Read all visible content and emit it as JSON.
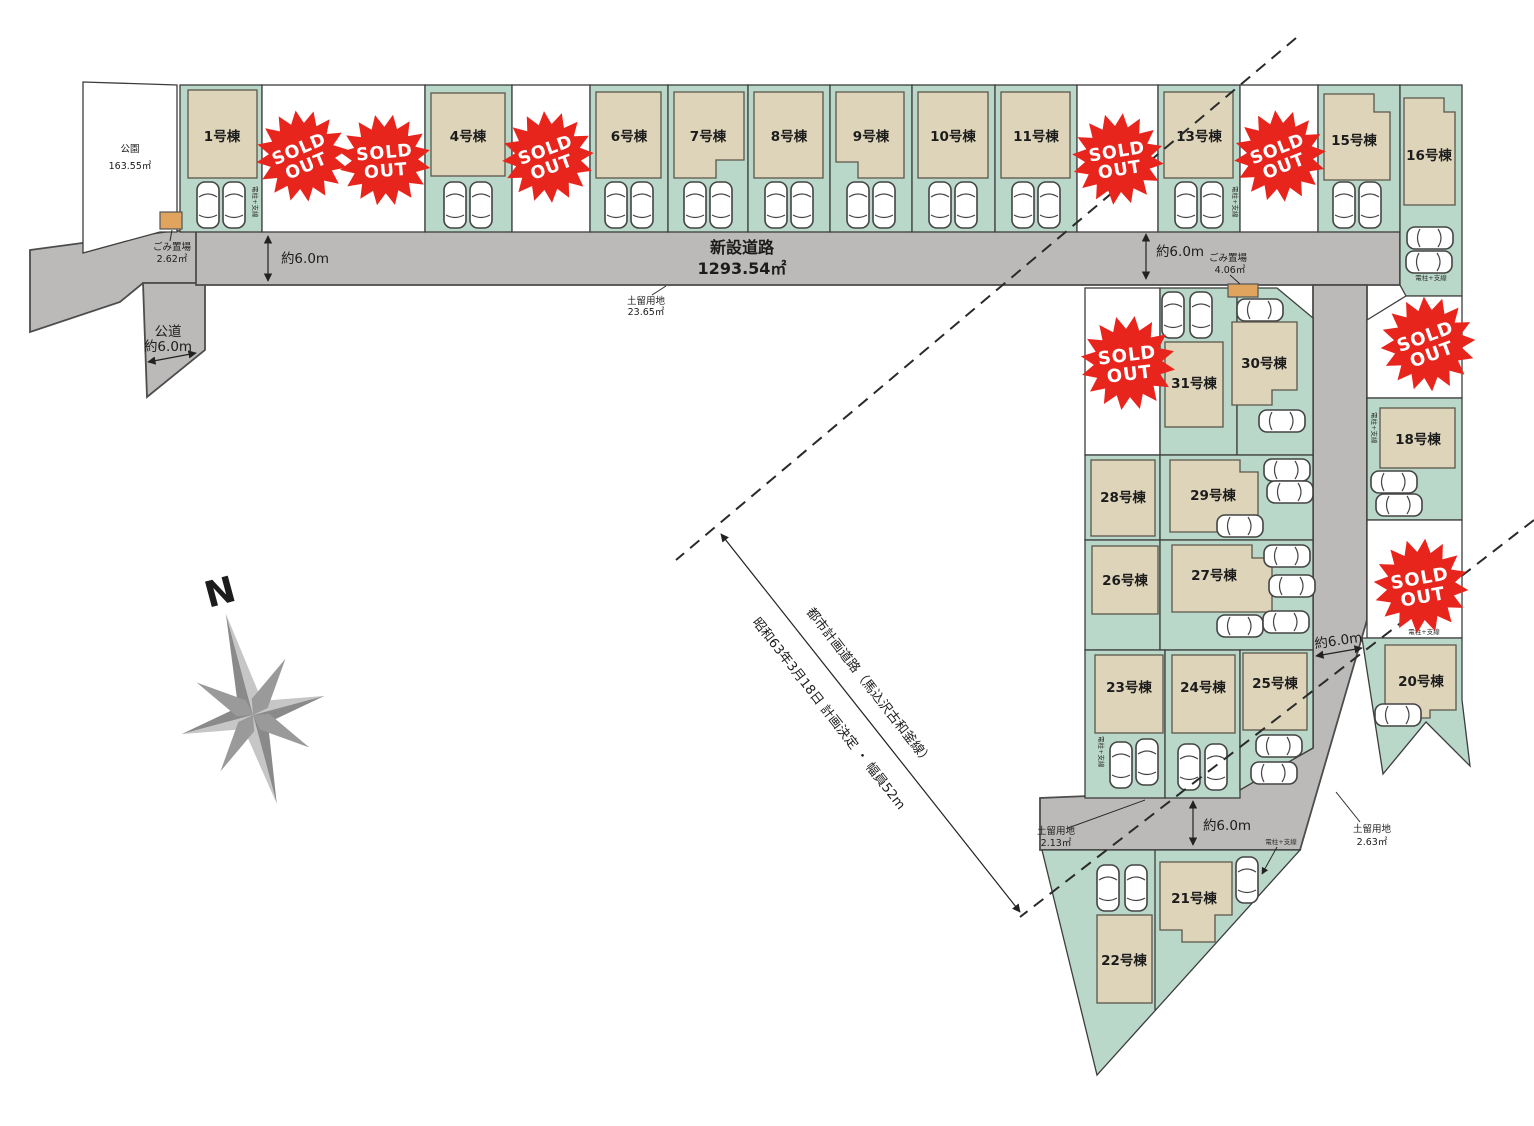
{
  "labels": {
    "approx6m": "約6.0m",
    "park_name": "公園",
    "park_area": "163.55㎡",
    "garbage_name": "ごみ置場",
    "garbage1_area": "2.62㎡",
    "garbage2_area": "4.06㎡",
    "new_road_name": "新設道路",
    "new_road_area": "1293.54㎡",
    "public_road_name": "公道",
    "retain_name": "土留用地",
    "retain1_area": "23.65㎡",
    "retain2_area": "2.13㎡",
    "retain3_area": "2.63㎡",
    "planned_road_line1": "都市計画道路（馬込沢古和釜線）",
    "planned_road_line2": "昭和63年3月18日 計画決定 ・ 幅員52m",
    "utility_pole": "電柱+支線",
    "compass_north": "N"
  },
  "sold_out": {
    "line1": "SOLD",
    "line2": "OUT"
  },
  "lots": {
    "1": "1号棟",
    "4": "4号棟",
    "6": "6号棟",
    "7": "7号棟",
    "8": "8号棟",
    "9": "9号棟",
    "10": "10号棟",
    "11": "11号棟",
    "13": "13号棟",
    "15": "15号棟",
    "16": "16号棟",
    "18": "18号棟",
    "20": "20号棟",
    "21": "21号棟",
    "22": "22号棟",
    "23": "23号棟",
    "24": "24号棟",
    "25": "25号棟",
    "26": "26号棟",
    "27": "27号棟",
    "28": "28号棟",
    "29": "29号棟",
    "30": "30号棟",
    "31": "31号棟"
  }
}
